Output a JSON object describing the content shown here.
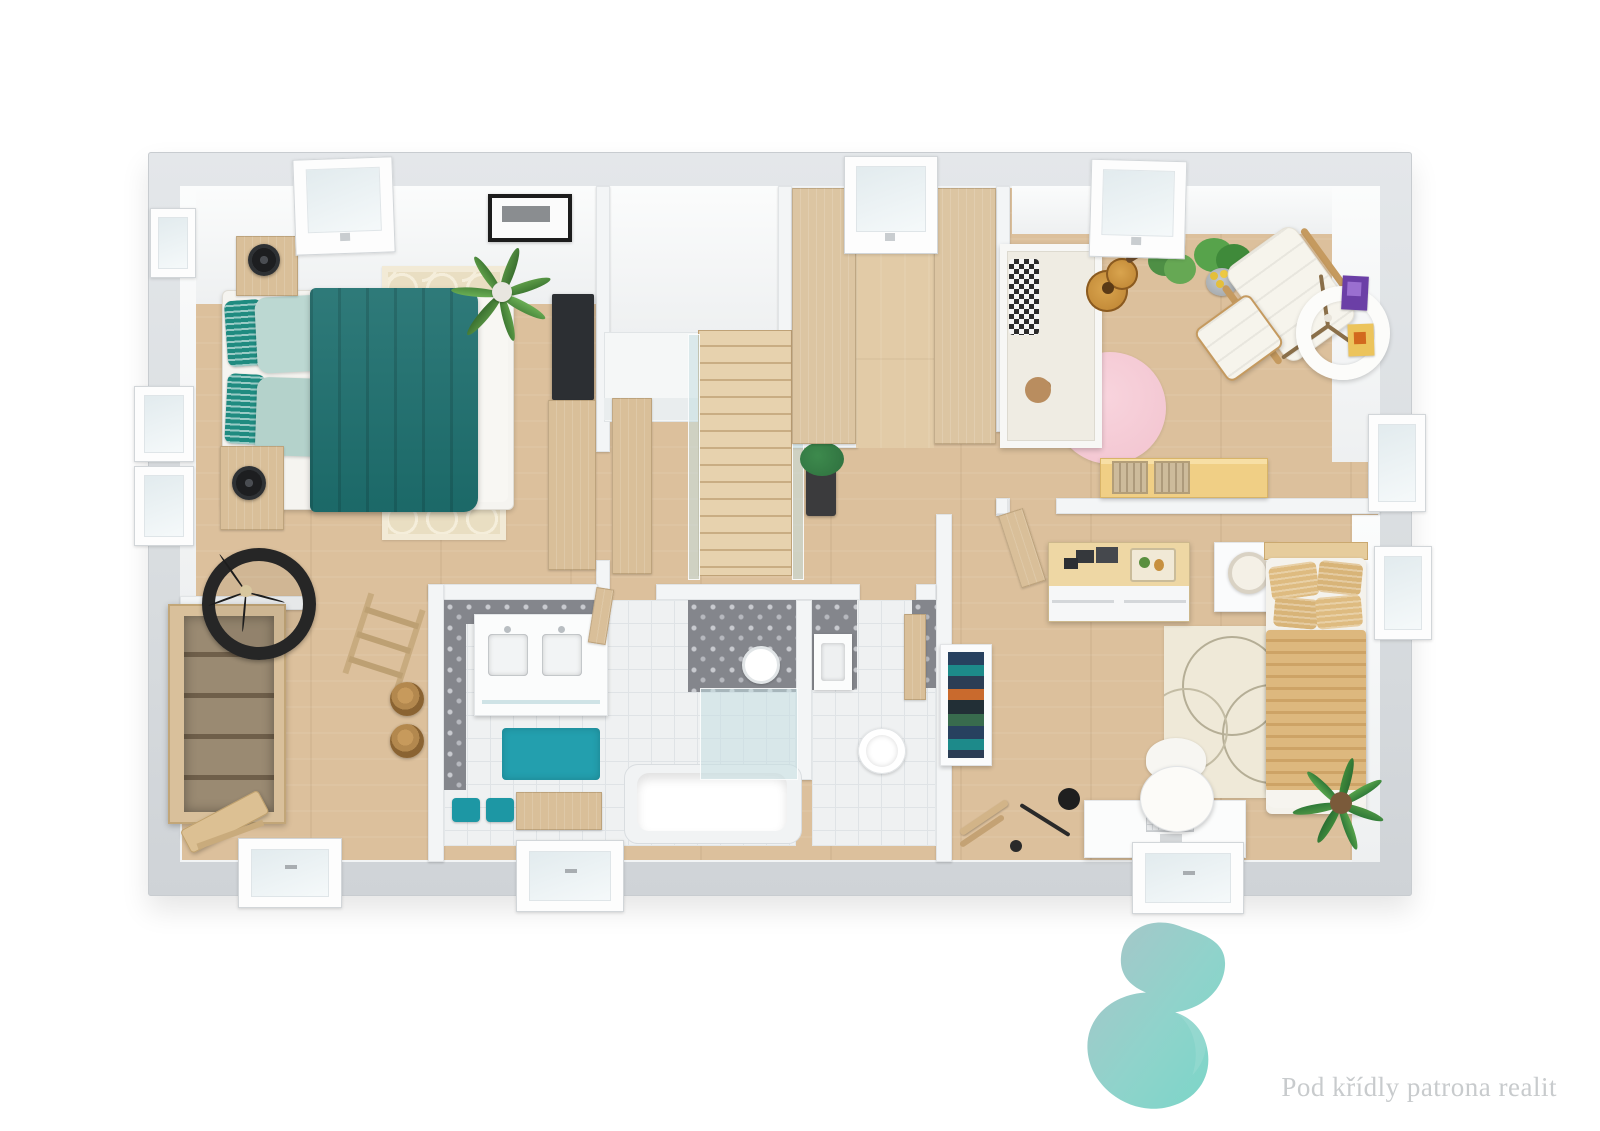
{
  "branding": {
    "logo_text": "Pod křídly patrona realit",
    "logo_gradient_start": "#a9c6c8",
    "logo_gradient_end": "#79d6c8",
    "logo_text_color": "#c8cbcd"
  },
  "palette": {
    "background": "#ffffff",
    "outer_wall": "#dbdfe2",
    "inner_wall": "#f3f5f6",
    "wood_floor": "#dcc09c",
    "wood_furniture": "#d9bf99",
    "teal_blanket": "#1d6f6e",
    "mint_pillow": "#bcd8d2",
    "teal_accent_pillow": "#1f8b80",
    "cream_rug": "#e9dec2",
    "pink_rug": "#f5cbd5",
    "teal_bath_rug": "#239fae",
    "tan_bed": "#ddb87e",
    "tile_floor": "#eff1f2",
    "pattern_tile": "#84868c",
    "kids_desk": "#f0cf85",
    "purple_art": "#6b3fa6",
    "yellow_art": "#ecc45c"
  },
  "rooms": [
    {
      "name": "master-bedroom",
      "furniture": [
        "double-bed",
        "teal-blanket",
        "mint-pillows",
        "patterned-pillows",
        "nightstand-left",
        "nightstand-right",
        "black-table-lamps",
        "trellis-rug",
        "palm-plant",
        "tv",
        "tv-cabinet",
        "wall-picture",
        "roof-window"
      ]
    },
    {
      "name": "landing-hall",
      "furniture": [
        "staircase",
        "glass-balustrade",
        "orchid-on-stand",
        "hall-cabinet",
        "ladder-rack",
        "wicker-baskets"
      ]
    },
    {
      "name": "walk-in-closet",
      "furniture": [
        "wardrobe-left",
        "wardrobe-right",
        "roof-window"
      ]
    },
    {
      "name": "kids-room",
      "furniture": [
        "crib",
        "teddy-bear",
        "pink-round-rug",
        "acoustic-guitar",
        "potted-plant",
        "plant-in-bucket",
        "lounge-chair",
        "ottoman",
        "tripod-floor-lamp",
        "wall-art-purple",
        "wall-art-yellow",
        "desk",
        "storage-baskets",
        "roof-window"
      ]
    },
    {
      "name": "bedroom",
      "furniture": [
        "single-bed",
        "striped-duvet",
        "tan-pillows",
        "dresser",
        "photo-frames",
        "tray",
        "nightstand",
        "table-lamp",
        "circle-rug",
        "bookcase",
        "desk",
        "monitor",
        "keyboard",
        "tulip-chair",
        "arc-floor-lamp",
        "plant",
        "valet-stand",
        "window"
      ]
    },
    {
      "name": "bathroom",
      "furniture": [
        "double-vanity",
        "two-sinks",
        "teal-rug",
        "teal-stools",
        "wood-bench",
        "bathtub",
        "walk-in-shower",
        "rain-shower-head",
        "pattern-tiles",
        "window"
      ]
    },
    {
      "name": "wc",
      "furniture": [
        "toilet",
        "hand-basin",
        "wood-door",
        "pattern-tiles"
      ]
    },
    {
      "name": "dressing-room",
      "furniture": [
        "open-shelf-unit",
        "rattan-round-chair",
        "wicker-baskets",
        "wood-stool",
        "entry-door"
      ]
    }
  ]
}
